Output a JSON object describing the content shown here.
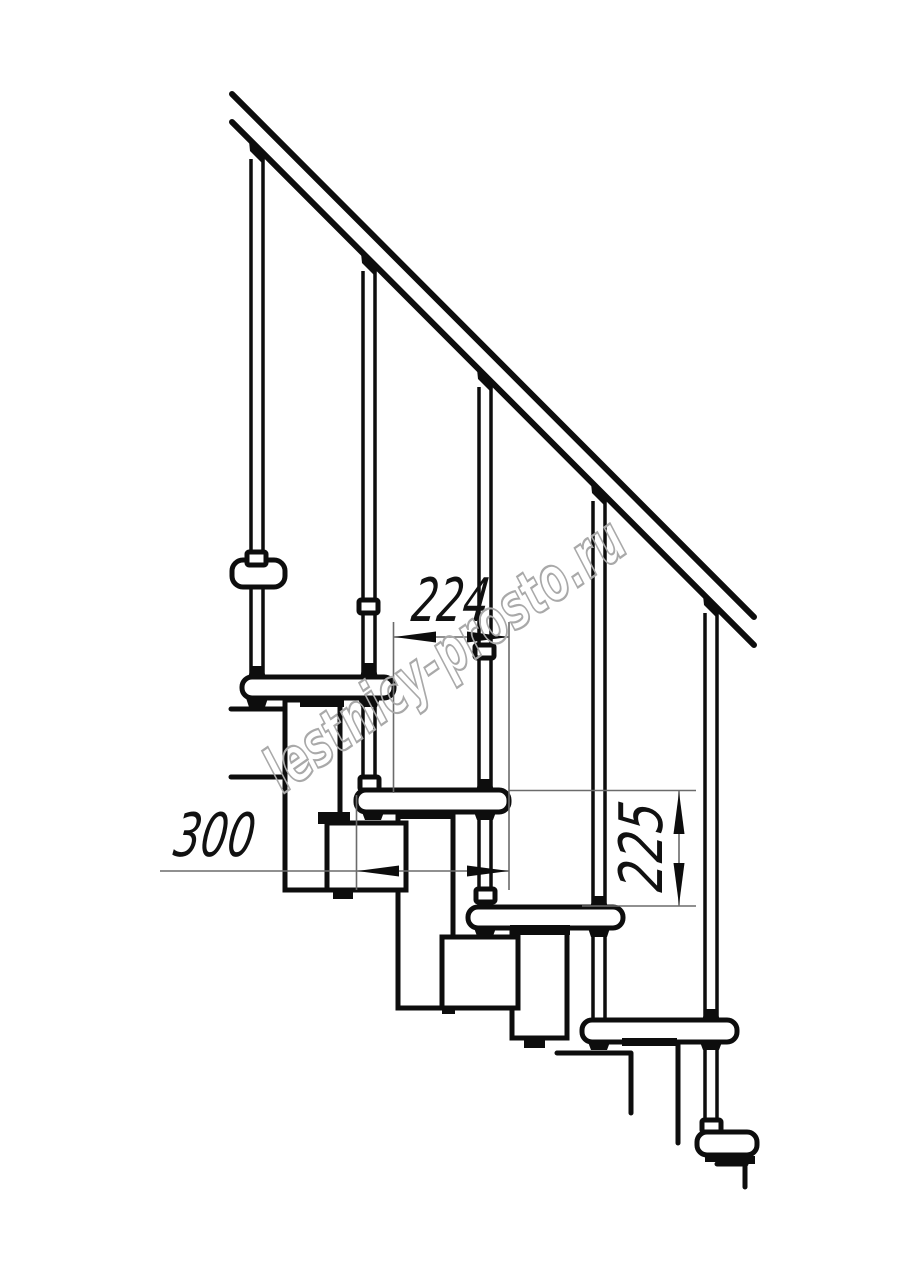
{
  "drawing": {
    "title": "modular-staircase-side-view",
    "watermark_text": "lestnicy-prosto.ru",
    "dimensions": {
      "step_run": "224",
      "tread_depth": "300",
      "riser_height": "225"
    },
    "colors": {
      "line": "#0d0d0d",
      "thin_line": "#6b6b6b",
      "watermark": "#a9a9a9",
      "background": "#ffffff"
    },
    "counts": {
      "balusters": 5,
      "treads": 6
    }
  }
}
